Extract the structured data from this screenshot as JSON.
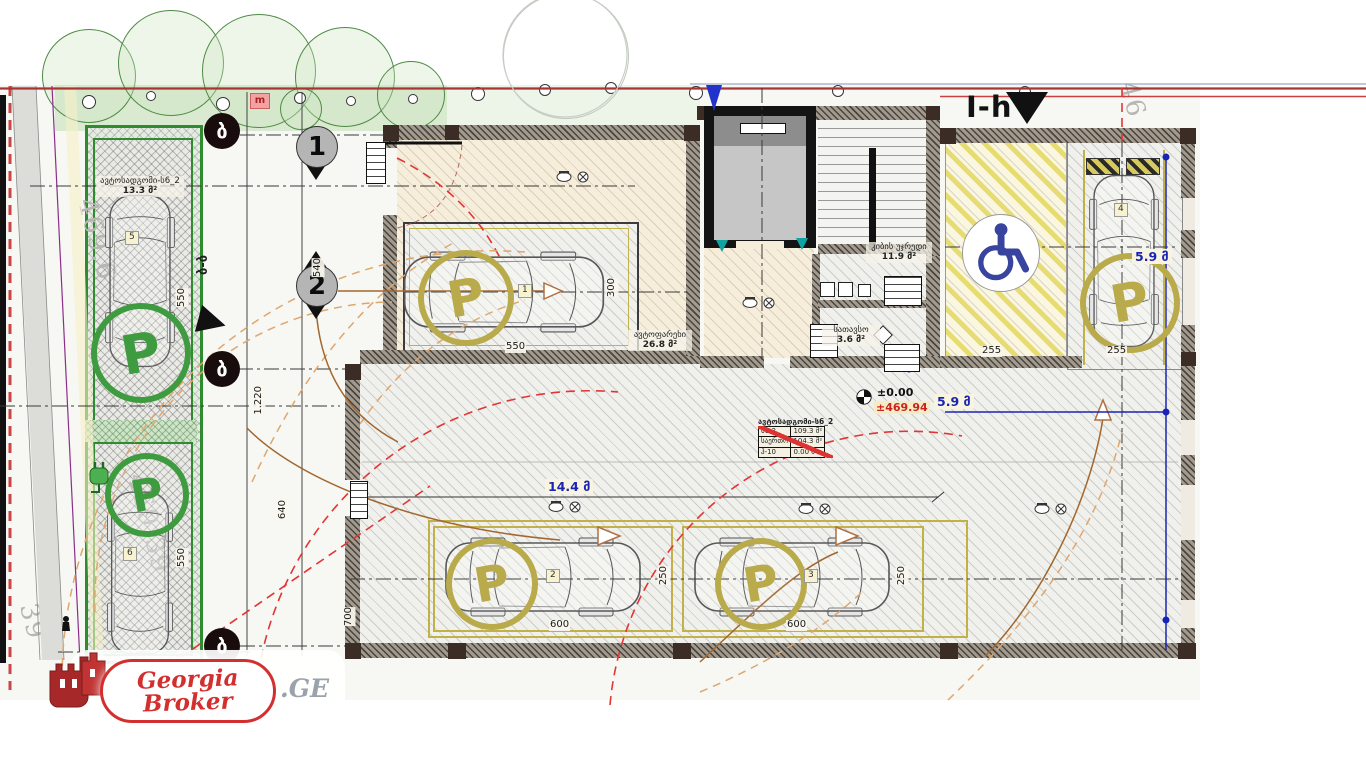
{
  "colors": {
    "accent_red": "#d32f2f",
    "parking_green": "#3f9b3f",
    "ring_yellow": "#b9aa4b",
    "blue_dim": "#1a24b4",
    "handicap_blue": "#38449e",
    "boundary_red": "#cc4545"
  },
  "logo": {
    "line1": "Georgia",
    "line2": "Broker",
    "suffix": ".GE"
  },
  "section_label": "I-h",
  "red_tag": "m",
  "section_cut": "ბ-ბ",
  "axis_letters": [
    "ბ",
    "ბ",
    "ბ"
  ],
  "section_numbers": [
    "1",
    "2"
  ],
  "street_elevations": [
    "469.6",
    "469.39",
    "39",
    "46"
  ],
  "elevation_marker": {
    "level": "±0.00",
    "absolute": "±469.94"
  },
  "blue_dims": [
    "14.4 მ",
    "5.9 მ",
    "5.9 მ"
  ],
  "dims": [
    "550",
    "300",
    "600",
    "250",
    "600",
    "250",
    "255",
    "255",
    "540",
    "1.220",
    "640",
    "700",
    "550",
    "550"
  ],
  "areas": [
    {
      "name": "ავტოფარეხი",
      "value": "26.8 მ²"
    },
    {
      "name": "კიბის უჯრედი",
      "value": "11.9 მ²"
    },
    {
      "name": "სათავსო",
      "value": "3.6 მ²"
    },
    {
      "name": "ავტოსადგომი-ს6_2",
      "value": "13.3 მ²"
    }
  ],
  "area_table": {
    "title": "ავტოსადგომი-ს6_2",
    "rows": [
      [
        "ს6-2",
        "109.3 მ²"
      ],
      [
        "საერთო",
        "104.3 მ²"
      ],
      [
        "ჰ-10",
        "0.00 მ²"
      ]
    ]
  },
  "parking_spots": [
    {
      "no": "1",
      "p": "P"
    },
    {
      "no": "2",
      "p": "P"
    },
    {
      "no": "3",
      "p": "P"
    },
    {
      "no": "4",
      "p": "P"
    },
    {
      "no": "5",
      "p": "P"
    },
    {
      "no": "6",
      "p": "P"
    }
  ]
}
